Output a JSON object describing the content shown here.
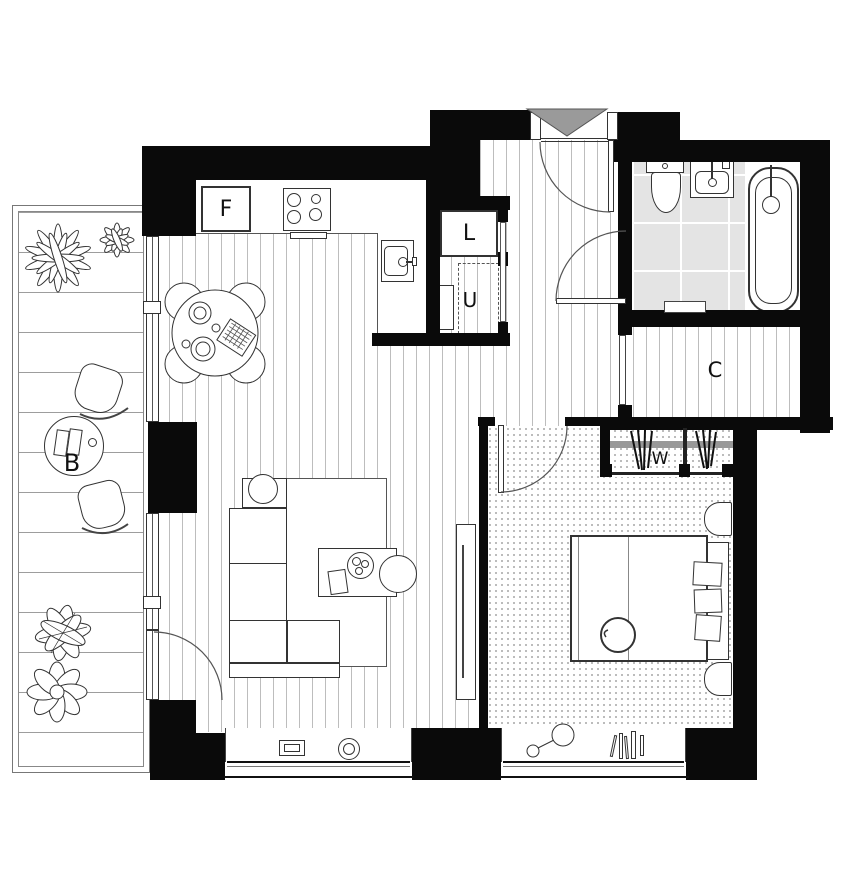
{
  "title": "apartment-floor-plan",
  "labels": {
    "fridge_f": "F",
    "linen_l": "L",
    "utility_u": "U",
    "cupboard_c": "C",
    "wardrobe_w": "W",
    "balcony_b": "B"
  },
  "colors": {
    "wall": "#0a0a0a",
    "tile_floor": "#e4e4e4",
    "entry_marker": "#9a9a9a",
    "outline": "#333333",
    "wardrobe_rail": "#989898"
  },
  "icons": {
    "entry_marker": "entry-triangle-icon",
    "hanging_rail": "clothes-hanger-icon"
  }
}
